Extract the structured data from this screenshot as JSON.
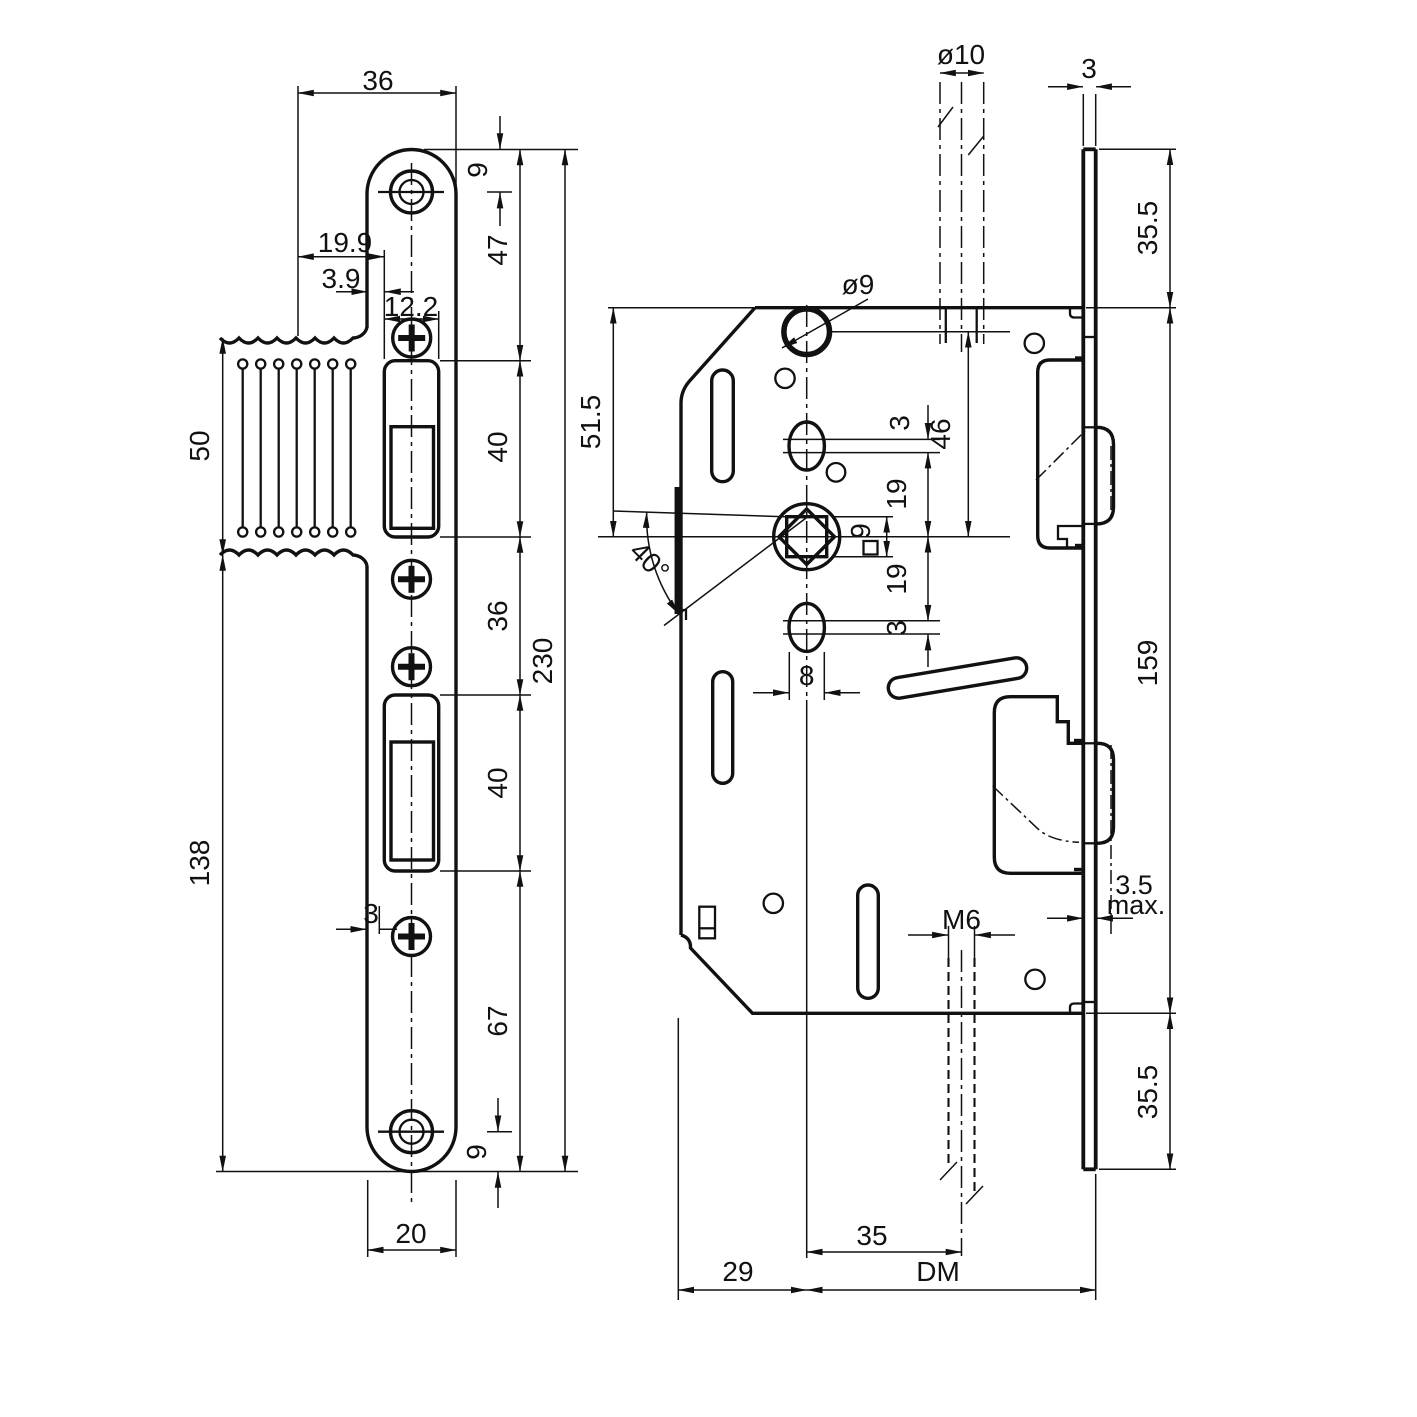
{
  "drawing": {
    "kind": "lock technical drawing",
    "left_view": {
      "dims": {
        "flange_width": "36",
        "offset_a": "19.9",
        "offset_b": "3.9",
        "cutout_width": "12.2",
        "screw_top_offset": "9",
        "top_to_latch_cutout": "47",
        "latch_cutout_height": "40",
        "between_cutouts": "36",
        "bolt_cutout_height": "40",
        "bolt_to_bottom": "67",
        "screw_bottom_offset": "9",
        "plate_length": "230",
        "lip_height": "50",
        "lower_length": "138",
        "screw_edge_offset": "3",
        "plate_width": "20"
      }
    },
    "right_view": {
      "dims": {
        "spindle_hole_dia": "ø10",
        "faceplate_thickness": "3",
        "faceplate_top_overhang": "35.5",
        "hole_dia": "ø9",
        "top_to_follower": "51.5",
        "lever_angle": "40°",
        "hole_to_follower": "46",
        "slot_play_top": "3",
        "pitch_top": "19",
        "follower_square": "9",
        "pitch_bottom": "19",
        "slot_play_bottom": "3",
        "slot_width": "8",
        "case_height": "159",
        "bolt_protrusion": "3.5",
        "bolt_protrusion_suffix": "max.",
        "screw_thread": "M6",
        "faceplate_bottom_overhang": "35.5",
        "spindle_to_screw": "35",
        "edge_to_spindle": "29",
        "backset": "DM"
      }
    }
  }
}
